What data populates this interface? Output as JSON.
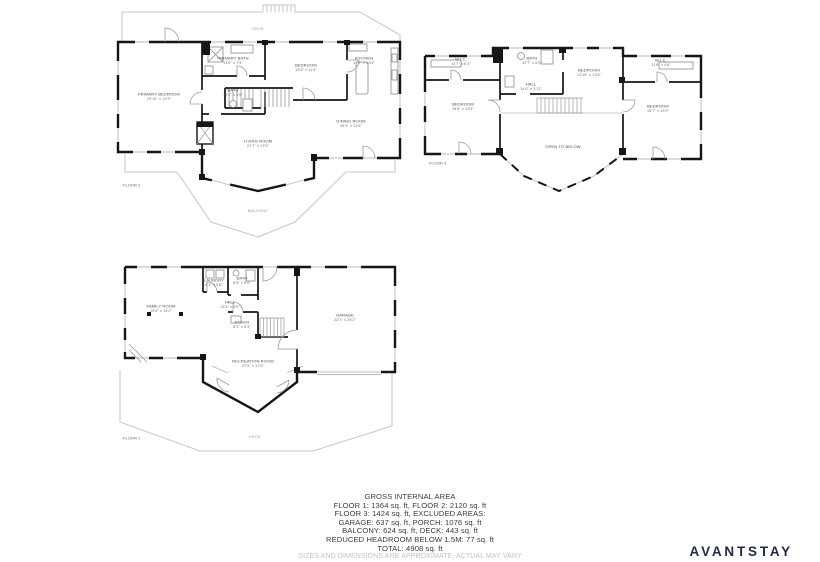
{
  "brand": {
    "logo_text": "AVANTSTAY",
    "logo_color": "#222b44"
  },
  "colors": {
    "walls": "#161616",
    "outdoor_outline": "#c9c9c9",
    "background": "#ffffff"
  },
  "summary": {
    "lines": [
      "GROSS INTERNAL AREA",
      "FLOOR 1: 1364 sq. ft, FLOOR 2: 2120 sq. ft",
      "FLOOR 3: 1424 sq. ft, EXCLUDED AREAS:",
      "GARAGE: 637 sq. ft, PORCH: 1076 sq. ft",
      "BALCONY: 624 sq. ft, DECK: 443 sq. ft",
      "REDUCED HEADROOM BELOW 1.5M: 77 sq. ft",
      "TOTAL: 4908 sq. ft"
    ],
    "disclaimer": "SIZES AND DIMENSIONS ARE APPROXIMATE, ACTUAL MAY VARY"
  },
  "floors": [
    {
      "name": "FLOOR 2",
      "rooms": [
        {
          "label": "DECK"
        },
        {
          "label": "PRIMARY BATH",
          "dims": "13'6\" x 7'9\""
        },
        {
          "label": "BEDROOM",
          "dims": "13'5\" x 11'6\""
        },
        {
          "label": "KITCHEN",
          "dims": "17'2\" x 13'6\""
        },
        {
          "label": "PRIMARY BEDROOM",
          "dims": "19'10\" x 13'9\""
        },
        {
          "label": "BATH",
          "dims": "11'2\" x 6'5\""
        },
        {
          "label": "LIVING ROOM",
          "dims": "21'7\" x 17'6\""
        },
        {
          "label": "DINING ROOM",
          "dims": "19'4\" x 13'6\""
        },
        {
          "label": "BALCONY"
        }
      ]
    },
    {
      "name": "FLOOR 3",
      "rooms": [
        {
          "label": "W.I.C.",
          "dims": "11'7\" x 6'4\""
        },
        {
          "label": "BATH",
          "dims": "12'7\" x 6'9\""
        },
        {
          "label": "BEDROOM",
          "dims": "13'10\" x 13'6\""
        },
        {
          "label": "W.I.C.",
          "dims": "11'8\" x 4'6\""
        },
        {
          "label": "BEDROOM",
          "dims": "15'6\" x 13'4\""
        },
        {
          "label": "BEDROOM",
          "dims": "15'7\" x 13'9\""
        },
        {
          "label": "HALL",
          "dims": "14'6\" x 3'11\""
        },
        {
          "label": "OPEN TO BELOW"
        }
      ]
    },
    {
      "name": "FLOOR 1",
      "rooms": [
        {
          "label": "FAMILY ROOM",
          "dims": "19'6\" x 14'2\""
        },
        {
          "label": "LAUNDRY",
          "dims": "6'1\" x 5'8\""
        },
        {
          "label": "BATH",
          "dims": "8'5\" x 5'0\""
        },
        {
          "label": "HALL",
          "dims": "13'6\" x 4'9\""
        },
        {
          "label": "FOYER",
          "dims": "8'2\" x 6'3\""
        },
        {
          "label": "GARAGE",
          "dims": "23'1\" x 26'2\""
        },
        {
          "label": "RECREATION ROOM",
          "dims": "27'9\" x 17'5\""
        },
        {
          "label": "DECK"
        }
      ]
    }
  ]
}
